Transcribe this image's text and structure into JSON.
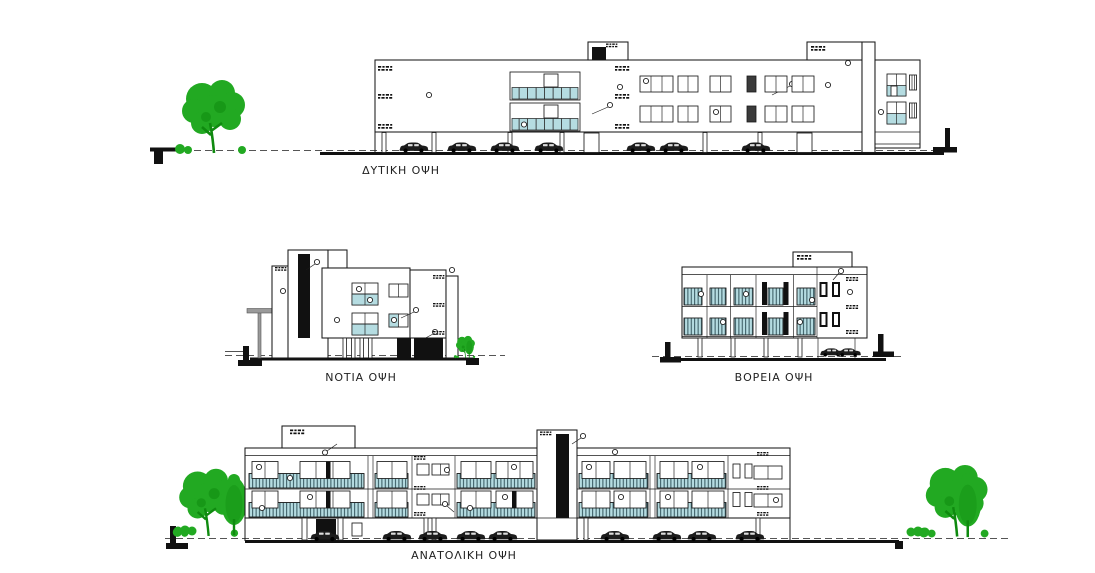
{
  "drawing": {
    "sheet_title": "Building elevations",
    "elevations": [
      {
        "id": "west",
        "label": "ΔΥΤΙΚΗ ΟΨΗ",
        "trees": 1,
        "cars": 7
      },
      {
        "id": "south",
        "label": "ΝΟΤΙΑ ΟΨΗ",
        "trees": 1,
        "cars": 0
      },
      {
        "id": "north",
        "label": "ΒΟΡΕΙΑ ΟΨΗ",
        "trees": 0,
        "cars": 2
      },
      {
        "id": "east",
        "label": "ΑΝΑΤΟΛΙΚΗ ΟΨΗ",
        "trees": 4,
        "cars": 9
      }
    ],
    "colors": {
      "background": "#ffffff",
      "line": "#1a1a1a",
      "glass": "#b5dce1",
      "tree": "#22a922",
      "treedark": "#0f8a0f",
      "black": "#111111",
      "grounddash": "#555555",
      "groundsolid": "#111111",
      "label": "#222222"
    }
  }
}
